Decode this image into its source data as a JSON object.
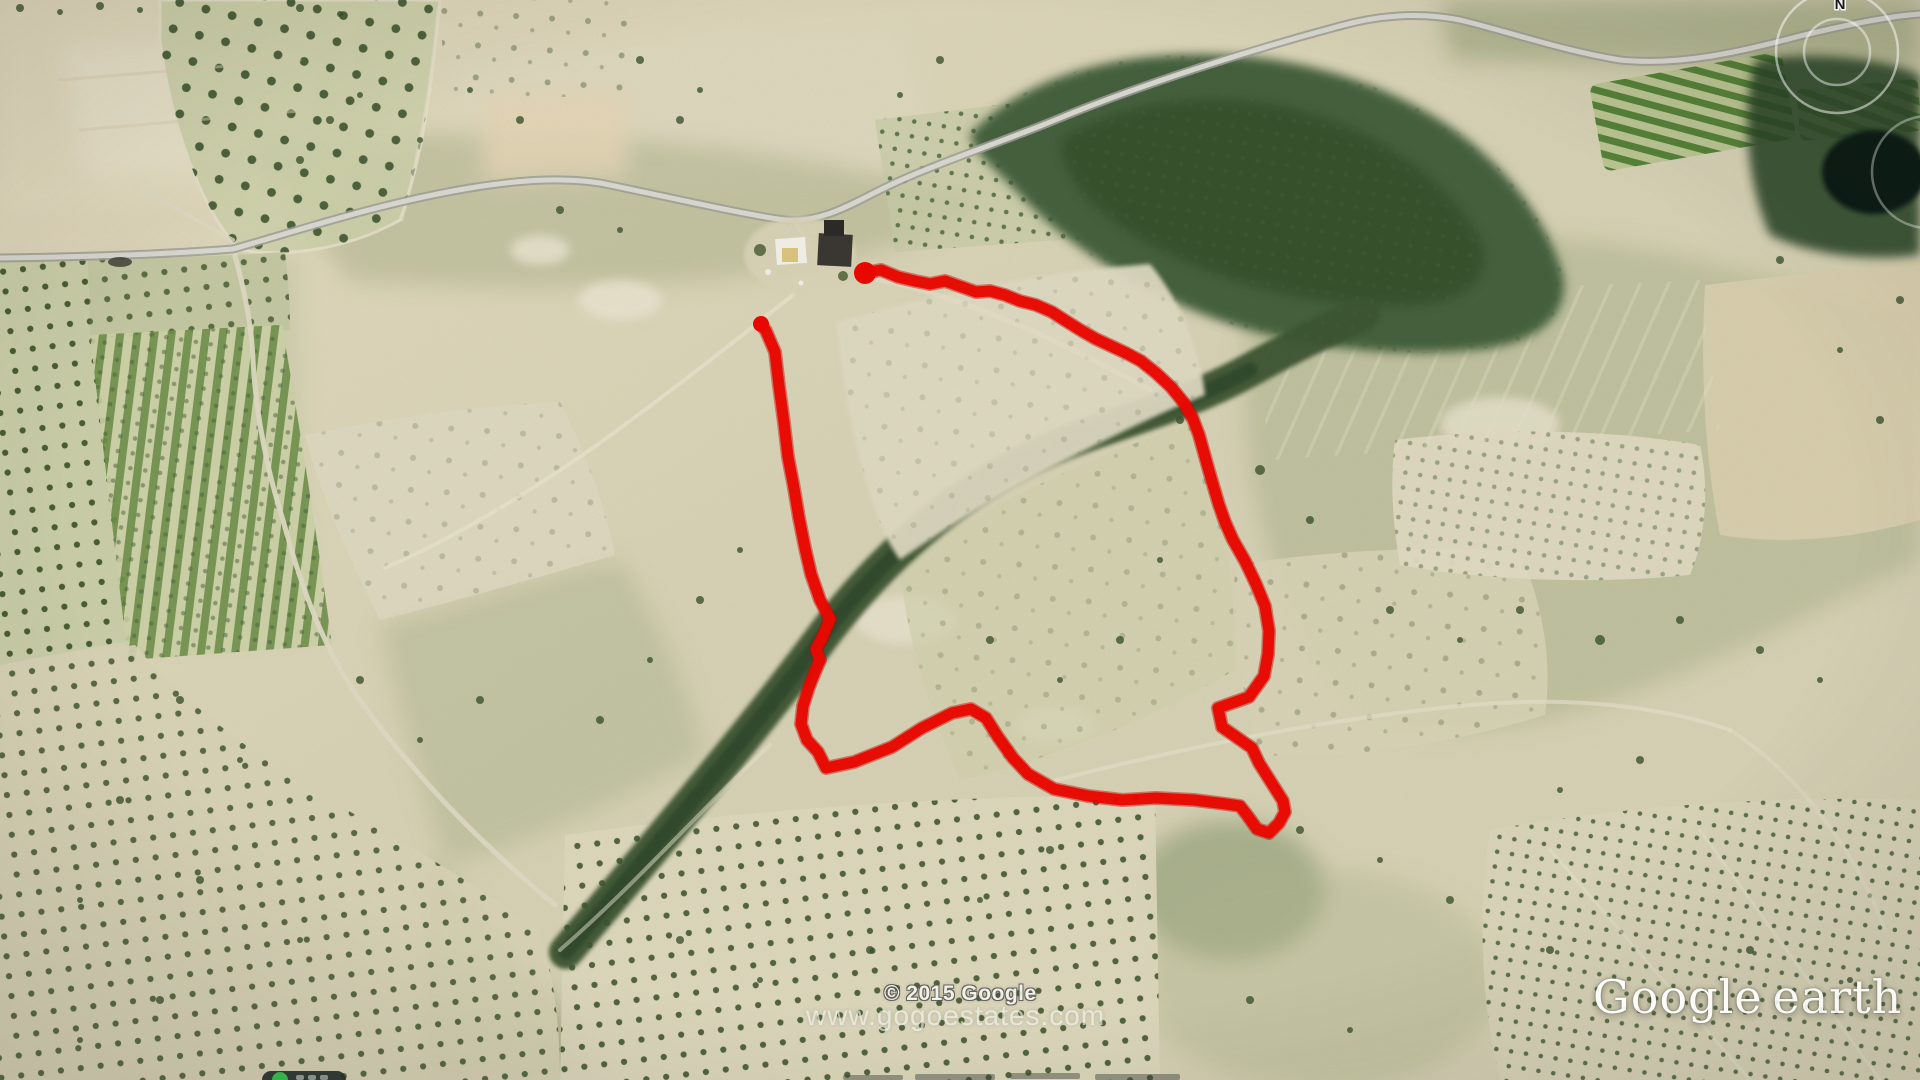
{
  "overlays": {
    "copyright": "© 2015 Google",
    "watermark": "www.gogoestates.com",
    "logo": {
      "word1": "Google",
      "word2": "earth"
    },
    "compass": {
      "label": "N"
    }
  },
  "boundary": {
    "color": "#e90800",
    "underlay_color": "#c00300",
    "stroke_width": 11,
    "open_path": true,
    "endpoint_radii": [
      11,
      8
    ],
    "endpoints": [
      [
        865,
        273
      ],
      [
        761,
        324
      ]
    ],
    "points": [
      [
        865,
        273
      ],
      [
        881,
        270
      ],
      [
        898,
        277
      ],
      [
        915,
        281
      ],
      [
        930,
        284
      ],
      [
        945,
        281
      ],
      [
        962,
        287
      ],
      [
        976,
        292
      ],
      [
        990,
        291
      ],
      [
        1005,
        295
      ],
      [
        1020,
        301
      ],
      [
        1036,
        305
      ],
      [
        1052,
        312
      ],
      [
        1066,
        321
      ],
      [
        1082,
        331
      ],
      [
        1096,
        339
      ],
      [
        1111,
        346
      ],
      [
        1126,
        353
      ],
      [
        1141,
        361
      ],
      [
        1156,
        373
      ],
      [
        1171,
        387
      ],
      [
        1184,
        403
      ],
      [
        1193,
        419
      ],
      [
        1199,
        435
      ],
      [
        1204,
        453
      ],
      [
        1209,
        471
      ],
      [
        1214,
        488
      ],
      [
        1219,
        505
      ],
      [
        1225,
        522
      ],
      [
        1233,
        540
      ],
      [
        1245,
        561
      ],
      [
        1256,
        584
      ],
      [
        1265,
        606
      ],
      [
        1269,
        631
      ],
      [
        1268,
        654
      ],
      [
        1264,
        676
      ],
      [
        1249,
        697
      ],
      [
        1218,
        708
      ],
      [
        1222,
        727
      ],
      [
        1252,
        748
      ],
      [
        1259,
        763
      ],
      [
        1271,
        782
      ],
      [
        1283,
        801
      ],
      [
        1285,
        812
      ],
      [
        1279,
        823
      ],
      [
        1269,
        833
      ],
      [
        1257,
        829
      ],
      [
        1247,
        815
      ],
      [
        1240,
        806
      ],
      [
        1226,
        804
      ],
      [
        1194,
        800
      ],
      [
        1156,
        798
      ],
      [
        1122,
        800
      ],
      [
        1088,
        796
      ],
      [
        1054,
        789
      ],
      [
        1028,
        774
      ],
      [
        1013,
        758
      ],
      [
        998,
        737
      ],
      [
        986,
        718
      ],
      [
        971,
        709
      ],
      [
        952,
        713
      ],
      [
        922,
        728
      ],
      [
        892,
        747
      ],
      [
        854,
        762
      ],
      [
        826,
        768
      ],
      [
        818,
        752
      ],
      [
        807,
        740
      ],
      [
        801,
        724
      ],
      [
        803,
        706
      ],
      [
        809,
        687
      ],
      [
        815,
        672
      ],
      [
        820,
        660
      ],
      [
        816,
        649
      ],
      [
        822,
        638
      ],
      [
        830,
        619
      ],
      [
        820,
        600
      ],
      [
        811,
        574
      ],
      [
        805,
        548
      ],
      [
        799,
        518
      ],
      [
        794,
        488
      ],
      [
        788,
        457
      ],
      [
        784,
        423
      ],
      [
        779,
        386
      ],
      [
        775,
        352
      ],
      [
        766,
        331
      ],
      [
        761,
        324
      ]
    ]
  }
}
